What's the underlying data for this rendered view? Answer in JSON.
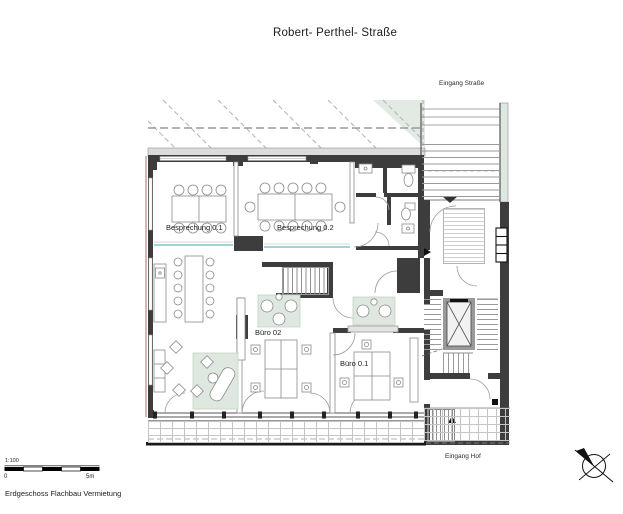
{
  "title": "Robert- Perthel- Straße",
  "caption": "Erdgeschoss Flachbau Vermietung",
  "labels": {
    "entrance_street": "Eingang Straße",
    "entrance_hof": "Eingang Hof"
  },
  "rooms": {
    "meeting_01": "Besprechung 0.1",
    "meeting_02": "Besprechung 0.2",
    "office_02": "Büro 02",
    "office_01": "Büro 0.1"
  },
  "scale_bar": {
    "ratio": "1:100",
    "zero": "0",
    "max": "5m"
  },
  "icons": {
    "north_arrow": "north-arrow-icon"
  },
  "colors": {
    "wall": "#3d3d3d",
    "green_tint": "#dfe8e0",
    "glass": "#9fd4da",
    "facade_accent": "#c4908e",
    "eave_gray": "#dcdcdc"
  }
}
